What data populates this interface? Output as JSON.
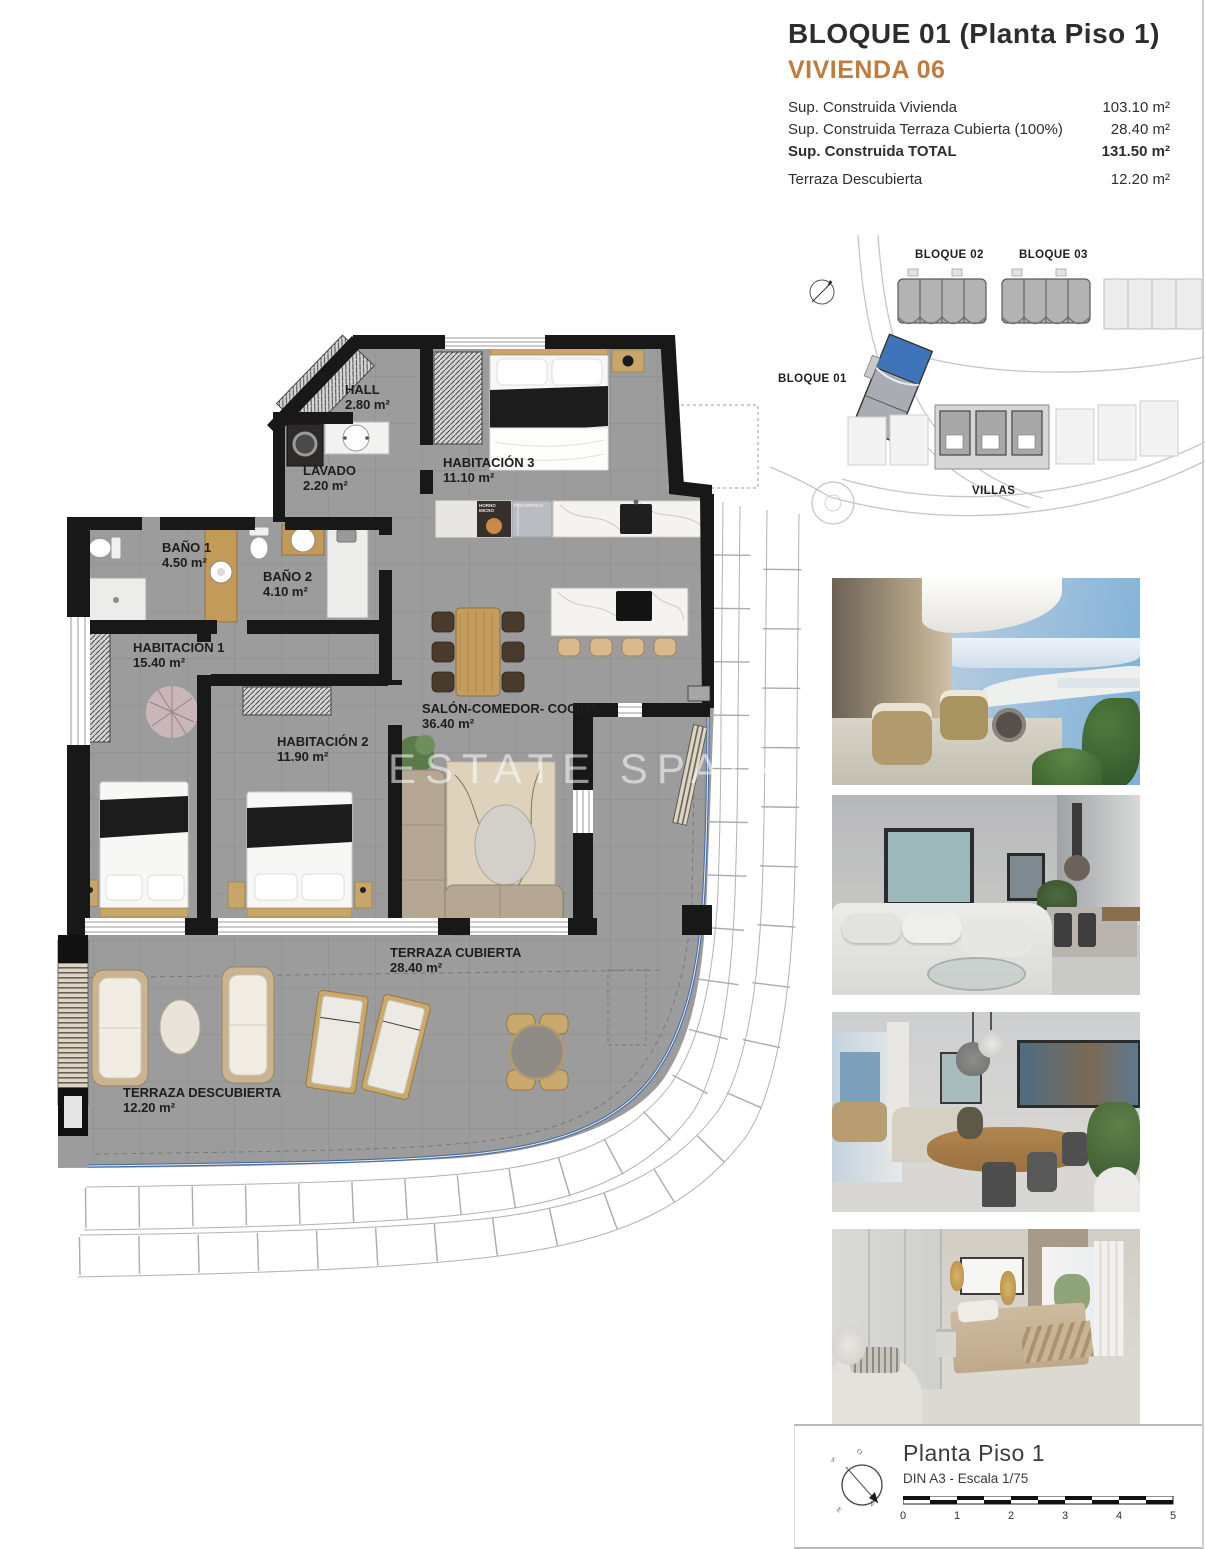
{
  "header": {
    "title": "BLOQUE 01  (Planta Piso 1)",
    "subtitle": "VIVIENDA 06",
    "rows": [
      {
        "label": "Sup. Construida Vivienda",
        "value": "103.10 m²"
      },
      {
        "label": "Sup. Construida Terraza Cubierta (100%)",
        "value": "28.40 m²"
      },
      {
        "label": "Sup. Construida TOTAL",
        "value": "131.50 m²"
      },
      {
        "label": "Terraza Descubierta",
        "value": "12.20 m²"
      }
    ]
  },
  "site_map": {
    "bloque01": "BLOQUE 01",
    "bloque02": "BLOQUE 02",
    "bloque03": "BLOQUE 03",
    "villas": "VILLAS"
  },
  "floor_plan": {
    "watermark": "ESTATE SPAIN -",
    "rooms": [
      {
        "name": "HALL",
        "area": "2.80 m²"
      },
      {
        "name": "LAVADO",
        "area": "2.20 m²"
      },
      {
        "name": "HABITACIÓN 3",
        "area": "11.10 m²"
      },
      {
        "name": "BAÑO 1",
        "area": "4.50 m²"
      },
      {
        "name": "BAÑO 2",
        "area": "4.10 m²"
      },
      {
        "name": "HABITACIÓN 1",
        "area": "15.40 m²"
      },
      {
        "name": "HABITACIÓN 2",
        "area": "11.90 m²"
      },
      {
        "name": "SALÓN-COMEDOR- COCINA",
        "area": "36.40 m²"
      },
      {
        "name": "TERRAZA CUBIERTA",
        "area": "28.40 m²"
      },
      {
        "name": "TERRAZA DESCUBIERTA",
        "area": "12.20 m²"
      }
    ],
    "appliances": {
      "oven": "HORNO MICRO",
      "fridge": "FRIGORIFICO"
    }
  },
  "footer": {
    "title": "Planta Piso 1",
    "scale_note": "DIN A3 - Escala 1/75",
    "ticks": [
      "0",
      "1",
      "2",
      "3",
      "4",
      "5"
    ],
    "compass": {
      "n": "N",
      "s": "S",
      "e": "E",
      "o": "O"
    }
  },
  "colors": {
    "accent": "#bf7c3f",
    "unit_highlight": "#3f75b8",
    "boundary": "#4a6d9e"
  }
}
